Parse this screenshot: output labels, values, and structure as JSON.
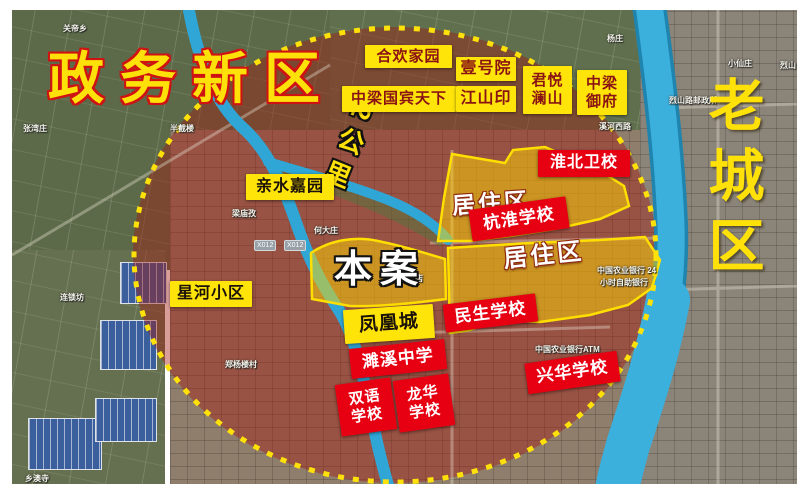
{
  "districts": {
    "left": "政务新区",
    "right": "老城区"
  },
  "radius_label": "2公里",
  "site": {
    "label": "本案"
  },
  "zones": [
    {
      "text": "居住区"
    },
    {
      "text": "居住区"
    }
  ],
  "communities": [
    {
      "text": "合欢家园"
    },
    {
      "text": "中梁国宾天下"
    },
    {
      "text": "壹号院"
    },
    {
      "text": "江山印"
    },
    {
      "name": "君悦澜山",
      "line1": "君悦",
      "line2": "澜山"
    },
    {
      "name": "中梁御府",
      "line1": "中梁",
      "line2": "御府"
    },
    {
      "text": "亲水嘉园"
    },
    {
      "text": "星河小区"
    },
    {
      "text": "凤凰城"
    }
  ],
  "schools": [
    {
      "text": "淮北卫校"
    },
    {
      "text": "杭淮学校"
    },
    {
      "text": "民生学校"
    },
    {
      "text": "濉溪中学"
    },
    {
      "name": "双语学校",
      "line1": "双语",
      "line2": "学校"
    },
    {
      "name": "龙华学校",
      "line1": "龙华",
      "line2": "学校"
    },
    {
      "text": "兴华学校"
    }
  ],
  "map_poi": [
    {
      "text": "关帝乡",
      "x": 63,
      "y": 23
    },
    {
      "text": "张湾庄",
      "x": 23,
      "y": 123
    },
    {
      "text": "半截楼",
      "x": 170,
      "y": 123
    },
    {
      "text": "梁庙孜",
      "x": 232,
      "y": 208
    },
    {
      "text": "何大庄",
      "x": 314,
      "y": 225
    },
    {
      "text": "连锁坊",
      "x": 60,
      "y": 292
    },
    {
      "text": "郑杨楼村",
      "x": 225,
      "y": 359
    },
    {
      "text": "鑫源饭店",
      "x": 391,
      "y": 273
    },
    {
      "text": "中国农业银行 24",
      "x": 597,
      "y": 265
    },
    {
      "text": "小时自助银行",
      "x": 600,
      "y": 277
    },
    {
      "text": "中国农业银行ATM",
      "x": 535,
      "y": 344
    },
    {
      "text": "杨庄",
      "x": 607,
      "y": 33
    },
    {
      "text": "小仙庄",
      "x": 728,
      "y": 58
    },
    {
      "text": "烈山",
      "x": 780,
      "y": 60
    },
    {
      "text": "烈山路邮政所",
      "x": 669,
      "y": 95
    },
    {
      "text": "溪河西路",
      "x": 599,
      "y": 121
    },
    {
      "text": "乡澳寺",
      "x": 25,
      "y": 473
    }
  ],
  "road_chips": [
    {
      "text": "X012",
      "x": 254,
      "y": 240
    },
    {
      "text": "X012",
      "x": 284,
      "y": 240
    },
    {
      "text": "S202",
      "x": 56,
      "y": 68
    }
  ],
  "colors": {
    "label_yellow": "#ffe40a",
    "label_red": "#e60012",
    "circle_yellow": "#ffe10a",
    "river_blue": "#3cb0dd",
    "overlay_red": "rgba(165,25,15,0.42)"
  }
}
